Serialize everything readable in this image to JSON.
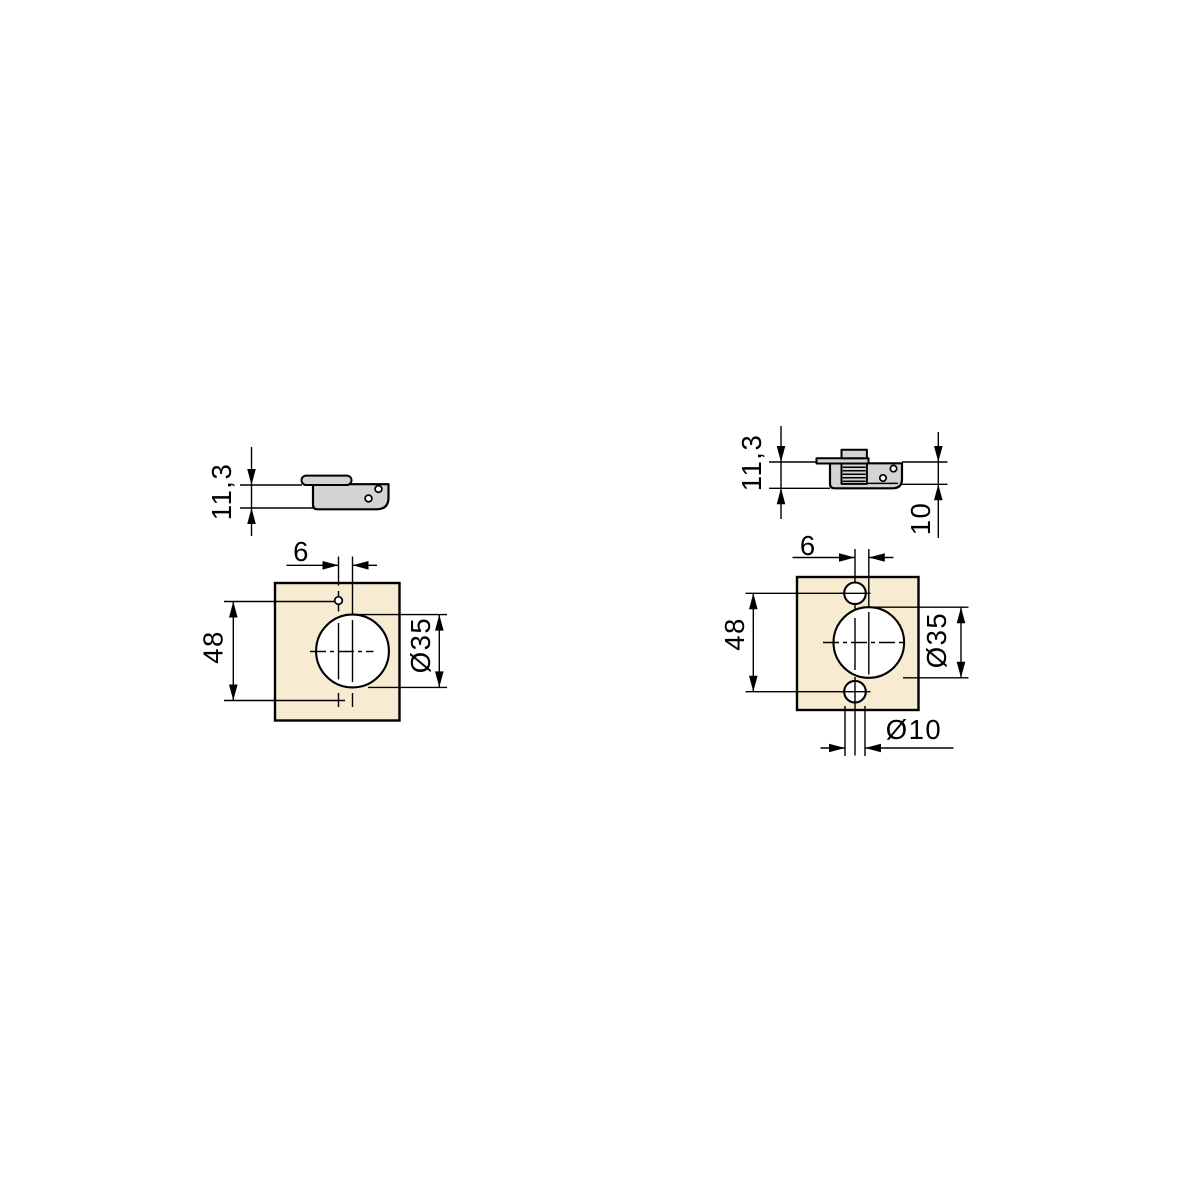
{
  "drawing": {
    "colors": {
      "background": "#ffffff",
      "panel_fill": "#f7ecd2",
      "metal_fill": "#d4d4d4",
      "line": "#000000"
    },
    "left_diagram": {
      "side_view": {
        "depth_label": "11,3"
      },
      "drill_pattern": {
        "cup_offset_label": "6",
        "screw_spacing_label": "48",
        "cup_diameter_label": "Ø35"
      }
    },
    "right_diagram": {
      "side_view": {
        "depth_label": "11,3",
        "mount_depth_label": "10"
      },
      "drill_pattern": {
        "cup_offset_label": "6",
        "screw_spacing_label": "48",
        "cup_diameter_label": "Ø35",
        "screw_diameter_label": "Ø10"
      }
    }
  }
}
